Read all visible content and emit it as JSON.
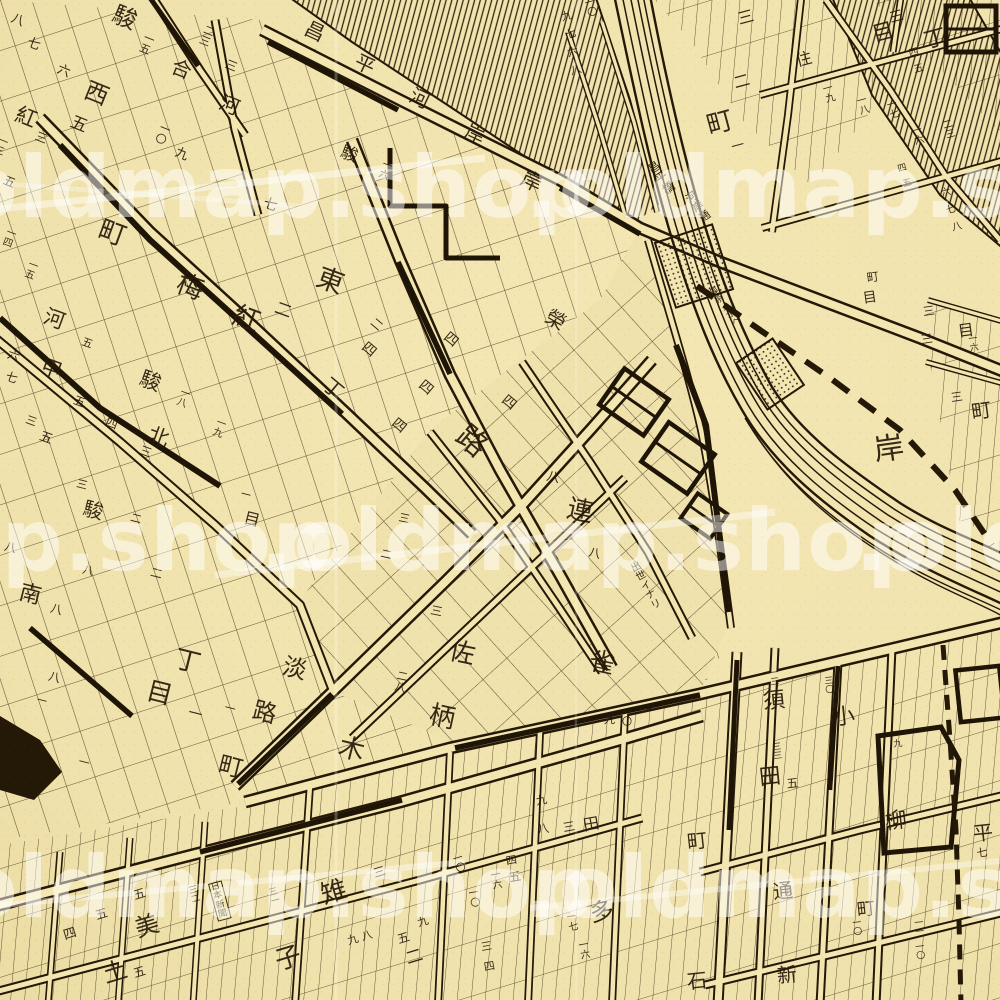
{
  "map": {
    "colors": {
      "paper": "#f0e2ac",
      "ink": "#241807",
      "watermark": "rgba(255,255,255,0.5)"
    },
    "watermark": {
      "text": ".oldmap.shop",
      "rows": [
        {
          "y": 185,
          "xs": [
            -75,
            525
          ]
        },
        {
          "y": 538,
          "xs": [
            -335,
            260,
            855
          ]
        },
        {
          "y": 885,
          "xs": [
            -75,
            525
          ]
        }
      ]
    },
    "labels": [
      {
        "t": "八",
        "x": 14,
        "y": 12,
        "s": 13,
        "r": 22
      },
      {
        "t": "七",
        "x": 30,
        "y": 36,
        "s": 13,
        "r": 22
      },
      {
        "t": "六",
        "x": 60,
        "y": 63,
        "s": 13,
        "r": 22
      },
      {
        "t": "駿",
        "x": 118,
        "y": 2,
        "s": 24,
        "r": 22
      },
      {
        "t": "一五",
        "x": 146,
        "y": 32,
        "s": 11,
        "r": 22,
        "v": 1
      },
      {
        "t": "西",
        "x": 90,
        "y": 78,
        "s": 24,
        "r": 22
      },
      {
        "t": "五",
        "x": 74,
        "y": 114,
        "s": 17,
        "r": 22
      },
      {
        "t": "紅",
        "x": 20,
        "y": 104,
        "s": 21,
        "r": 22
      },
      {
        "t": "三",
        "x": 38,
        "y": 130,
        "s": 12,
        "r": 22
      },
      {
        "t": "二三",
        "x": 206,
        "y": 24,
        "s": 11,
        "r": 22,
        "v": 1
      },
      {
        "t": "三",
        "x": 228,
        "y": 58,
        "s": 12,
        "r": 22
      },
      {
        "t": "合",
        "x": 176,
        "y": 56,
        "s": 20,
        "r": 22
      },
      {
        "t": "河",
        "x": 224,
        "y": 92,
        "s": 20,
        "r": 22
      },
      {
        "t": "一〇",
        "x": 162,
        "y": 122,
        "s": 11,
        "r": 22,
        "v": 1
      },
      {
        "t": "九",
        "x": 178,
        "y": 146,
        "s": 13,
        "r": 22
      },
      {
        "t": "五",
        "x": 6,
        "y": 174,
        "s": 12,
        "r": 22
      },
      {
        "t": "一三",
        "x": 0,
        "y": 136,
        "s": 10,
        "r": 22,
        "v": 1
      },
      {
        "t": "町",
        "x": 104,
        "y": 216,
        "s": 27,
        "r": 20
      },
      {
        "t": "梅",
        "x": 182,
        "y": 270,
        "s": 27,
        "r": 20
      },
      {
        "t": "紅",
        "x": 238,
        "y": 302,
        "s": 27,
        "r": 20
      },
      {
        "t": "東",
        "x": 322,
        "y": 264,
        "s": 27,
        "r": 20
      },
      {
        "t": "二",
        "x": 278,
        "y": 300,
        "s": 17,
        "r": 20
      },
      {
        "t": "七",
        "x": 266,
        "y": 196,
        "s": 14,
        "r": 20
      },
      {
        "t": "駿",
        "x": 344,
        "y": 144,
        "s": 17,
        "r": 20
      },
      {
        "t": "一六",
        "x": 384,
        "y": 160,
        "s": 10,
        "r": 20,
        "v": 1
      },
      {
        "t": "一四",
        "x": 8,
        "y": 228,
        "s": 10,
        "r": 20,
        "v": 1
      },
      {
        "t": "一五",
        "x": 30,
        "y": 260,
        "s": 10,
        "r": 20,
        "v": 1
      },
      {
        "t": "六",
        "x": 10,
        "y": 348,
        "s": 12,
        "r": 20
      },
      {
        "t": "七",
        "x": 8,
        "y": 370,
        "s": 12,
        "r": 20
      },
      {
        "t": "河",
        "x": 48,
        "y": 306,
        "s": 21,
        "r": 20
      },
      {
        "t": "甲",
        "x": 45,
        "y": 356,
        "s": 21,
        "r": 20
      },
      {
        "t": "駿",
        "x": 144,
        "y": 368,
        "s": 21,
        "r": 20
      },
      {
        "t": "北",
        "x": 152,
        "y": 424,
        "s": 21,
        "r": 20
      },
      {
        "t": "五",
        "x": 84,
        "y": 336,
        "s": 11,
        "r": 20
      },
      {
        "t": "五",
        "x": 76,
        "y": 394,
        "s": 12,
        "r": 20
      },
      {
        "t": "四",
        "x": 108,
        "y": 416,
        "s": 12,
        "r": 20
      },
      {
        "t": "三",
        "x": 142,
        "y": 444,
        "s": 12,
        "r": 20
      },
      {
        "t": "一八",
        "x": 182,
        "y": 388,
        "s": 10,
        "r": 20,
        "v": 1
      },
      {
        "t": "一九",
        "x": 218,
        "y": 418,
        "s": 10,
        "r": 20,
        "v": 1
      },
      {
        "t": "五",
        "x": 42,
        "y": 430,
        "s": 13,
        "r": 20
      },
      {
        "t": "三",
        "x": 28,
        "y": 414,
        "s": 11,
        "r": 20
      },
      {
        "t": "二",
        "x": 376,
        "y": 316,
        "s": 12,
        "r": 40
      },
      {
        "t": "四",
        "x": 368,
        "y": 340,
        "s": 14,
        "r": 40
      },
      {
        "t": "四",
        "x": 450,
        "y": 330,
        "s": 14,
        "r": 40
      },
      {
        "t": "四",
        "x": 425,
        "y": 378,
        "s": 14,
        "r": 40
      },
      {
        "t": "四",
        "x": 398,
        "y": 416,
        "s": 14,
        "r": 40
      },
      {
        "t": "四",
        "x": 508,
        "y": 393,
        "s": 14,
        "r": 40
      },
      {
        "t": "丁",
        "x": 332,
        "y": 374,
        "s": 20,
        "r": 40
      },
      {
        "t": "路",
        "x": 470,
        "y": 420,
        "s": 30,
        "r": 40
      },
      {
        "t": "榮",
        "x": 552,
        "y": 306,
        "s": 20,
        "r": 30
      },
      {
        "t": "岸",
        "x": 526,
        "y": 168,
        "s": 21,
        "r": 25
      },
      {
        "t": "昌",
        "x": 310,
        "y": 18,
        "s": 20,
        "r": 25
      },
      {
        "t": "平",
        "x": 360,
        "y": 51,
        "s": 20,
        "r": 25
      },
      {
        "t": "河",
        "x": 415,
        "y": 85,
        "s": 20,
        "r": 25
      },
      {
        "t": "岸",
        "x": 470,
        "y": 121,
        "s": 20,
        "r": 25
      },
      {
        "t": "九",
        "x": 560,
        "y": 12,
        "s": 11,
        "r": -15
      },
      {
        "t": "七",
        "x": 564,
        "y": 30,
        "s": 11,
        "r": -15
      },
      {
        "t": "六",
        "x": 566,
        "y": 48,
        "s": 11,
        "r": -15
      },
      {
        "t": "八",
        "x": 569,
        "y": 66,
        "s": 11,
        "r": -15
      },
      {
        "t": "一〇",
        "x": 584,
        "y": 0,
        "s": 10,
        "r": -15,
        "v": 1
      },
      {
        "t": "昌平橋",
        "x": 646,
        "y": 166,
        "s": 12,
        "r": -35,
        "v": 1
      },
      {
        "t": "河岸通",
        "x": 684,
        "y": 196,
        "s": 11,
        "r": -35,
        "v": 1
      },
      {
        "t": "御茶ノ水ヘ",
        "x": 708,
        "y": 292,
        "s": 9,
        "r": -38,
        "v": 1
      },
      {
        "t": "住",
        "x": 794,
        "y": 54,
        "s": 16,
        "r": -15
      },
      {
        "t": "三",
        "x": 736,
        "y": 12,
        "s": 16,
        "r": -15
      },
      {
        "t": "二",
        "x": 732,
        "y": 76,
        "s": 16,
        "r": -15
      },
      {
        "t": "町",
        "x": 704,
        "y": 114,
        "s": 26,
        "r": -15
      },
      {
        "t": "一",
        "x": 730,
        "y": 142,
        "s": 13,
        "r": -15
      },
      {
        "t": "三",
        "x": 888,
        "y": 12,
        "s": 14,
        "r": -15
      },
      {
        "t": "目",
        "x": 870,
        "y": 26,
        "s": 22,
        "r": -15
      },
      {
        "t": "丁",
        "x": 922,
        "y": 32,
        "s": 22,
        "r": -15
      },
      {
        "t": "四",
        "x": 908,
        "y": 50,
        "s": 10,
        "r": -15
      },
      {
        "t": "五",
        "x": 913,
        "y": 66,
        "s": 10,
        "r": -15
      },
      {
        "t": "一九",
        "x": 822,
        "y": 86,
        "s": 10,
        "r": -15,
        "v": 1
      },
      {
        "t": "一八",
        "x": 856,
        "y": 98,
        "s": 10,
        "r": -15,
        "v": 1
      },
      {
        "t": "一七",
        "x": 886,
        "y": 102,
        "s": 10,
        "r": -15,
        "v": 1
      },
      {
        "t": "一六",
        "x": 911,
        "y": 128,
        "s": 10,
        "r": -15,
        "v": 1
      },
      {
        "t": "二三",
        "x": 942,
        "y": 122,
        "s": 10,
        "r": -15,
        "v": 1
      },
      {
        "t": "六",
        "x": 940,
        "y": 190,
        "s": 10,
        "r": -15
      },
      {
        "t": "七",
        "x": 945,
        "y": 207,
        "s": 10,
        "r": -15
      },
      {
        "t": "八",
        "x": 951,
        "y": 224,
        "s": 10,
        "r": -15
      },
      {
        "t": "四",
        "x": 897,
        "y": 166,
        "s": 9,
        "r": -15
      },
      {
        "t": "五",
        "x": 902,
        "y": 181,
        "s": 9,
        "r": -15
      },
      {
        "t": "町",
        "x": 866,
        "y": 272,
        "s": 12,
        "r": -8
      },
      {
        "t": "目",
        "x": 862,
        "y": 292,
        "s": 14,
        "r": -8
      },
      {
        "t": "三",
        "x": 922,
        "y": 306,
        "s": 12,
        "r": -8
      },
      {
        "t": "三",
        "x": 920,
        "y": 334,
        "s": 12,
        "r": -8
      },
      {
        "t": "目",
        "x": 957,
        "y": 324,
        "s": 16,
        "r": -8
      },
      {
        "t": "一六",
        "x": 968,
        "y": 336,
        "s": 9,
        "r": -8,
        "v": 1
      },
      {
        "t": "岸",
        "x": 872,
        "y": 436,
        "s": 30,
        "r": -8
      },
      {
        "t": "町",
        "x": 970,
        "y": 402,
        "s": 20,
        "r": -8
      },
      {
        "t": "三",
        "x": 950,
        "y": 392,
        "s": 12,
        "r": -8
      },
      {
        "t": "連",
        "x": 570,
        "y": 496,
        "s": 26,
        "r": 12
      },
      {
        "t": "雀",
        "x": 592,
        "y": 648,
        "s": 26,
        "r": 12
      },
      {
        "t": "八",
        "x": 548,
        "y": 470,
        "s": 13,
        "r": 12
      },
      {
        "t": "八",
        "x": 590,
        "y": 546,
        "s": 12,
        "r": 12
      },
      {
        "t": "佐",
        "x": 452,
        "y": 638,
        "s": 26,
        "r": 12
      },
      {
        "t": "柄",
        "x": 432,
        "y": 702,
        "s": 26,
        "r": 12
      },
      {
        "t": "三",
        "x": 432,
        "y": 604,
        "s": 12,
        "r": 12
      },
      {
        "t": "二八",
        "x": 398,
        "y": 670,
        "s": 11,
        "r": 12,
        "v": 1
      },
      {
        "t": "三",
        "x": 400,
        "y": 512,
        "s": 11,
        "r": 12
      },
      {
        "t": "二",
        "x": 382,
        "y": 548,
        "s": 11,
        "r": 12
      },
      {
        "t": "出世イナリ",
        "x": 630,
        "y": 566,
        "s": 10,
        "r": -28,
        "v": 1
      },
      {
        "t": "九",
        "x": 604,
        "y": 714,
        "s": 11,
        "r": 0
      },
      {
        "t": "一〇",
        "x": 622,
        "y": 708,
        "s": 10,
        "r": 0,
        "v": 1
      },
      {
        "t": "一",
        "x": 642,
        "y": 706,
        "s": 10,
        "r": 0
      },
      {
        "t": "淡",
        "x": 286,
        "y": 654,
        "s": 24,
        "r": 14
      },
      {
        "t": "路",
        "x": 256,
        "y": 698,
        "s": 24,
        "r": 14
      },
      {
        "t": "一",
        "x": 226,
        "y": 702,
        "s": 11,
        "r": 14
      },
      {
        "t": "木",
        "x": 342,
        "y": 734,
        "s": 26,
        "r": 14
      },
      {
        "t": "南",
        "x": 22,
        "y": 582,
        "s": 22,
        "r": 14
      },
      {
        "t": "八",
        "x": 6,
        "y": 540,
        "s": 12,
        "r": 14
      },
      {
        "t": "八",
        "x": 52,
        "y": 602,
        "s": 12,
        "r": 14
      },
      {
        "t": "八",
        "x": 50,
        "y": 670,
        "s": 12,
        "r": 14
      },
      {
        "t": "一",
        "x": 38,
        "y": 696,
        "s": 10,
        "r": 14
      },
      {
        "t": "丁",
        "x": 178,
        "y": 646,
        "s": 26,
        "r": 14
      },
      {
        "t": "目",
        "x": 150,
        "y": 678,
        "s": 26,
        "r": 14
      },
      {
        "t": "一",
        "x": 190,
        "y": 706,
        "s": 14,
        "r": 14
      },
      {
        "t": "町",
        "x": 222,
        "y": 752,
        "s": 24,
        "r": 14
      },
      {
        "t": "一",
        "x": 80,
        "y": 756,
        "s": 11,
        "r": 14
      },
      {
        "t": "二",
        "x": 152,
        "y": 566,
        "s": 12,
        "r": 14
      },
      {
        "t": "駿",
        "x": 86,
        "y": 498,
        "s": 20,
        "r": 14
      },
      {
        "t": "三",
        "x": 78,
        "y": 478,
        "s": 11,
        "r": 14
      },
      {
        "t": "八",
        "x": 84,
        "y": 564,
        "s": 11,
        "r": 14
      },
      {
        "t": "一",
        "x": 242,
        "y": 490,
        "s": 10,
        "r": 14
      },
      {
        "t": "目",
        "x": 246,
        "y": 510,
        "s": 16,
        "r": 14
      },
      {
        "t": "二",
        "x": 132,
        "y": 512,
        "s": 11,
        "r": 14
      },
      {
        "t": "須",
        "x": 762,
        "y": 692,
        "s": 22,
        "r": -6
      },
      {
        "t": "田",
        "x": 758,
        "y": 768,
        "s": 22,
        "r": -6
      },
      {
        "t": "五",
        "x": 786,
        "y": 778,
        "s": 12,
        "r": -6
      },
      {
        "t": "三三",
        "x": 772,
        "y": 744,
        "s": 9,
        "r": -6,
        "v": 1
      },
      {
        "t": "一三",
        "x": 769,
        "y": 670,
        "s": 9,
        "r": -6,
        "v": 1
      },
      {
        "t": "小",
        "x": 832,
        "y": 708,
        "s": 22,
        "r": -6
      },
      {
        "t": "三〇",
        "x": 824,
        "y": 678,
        "s": 9,
        "r": -6,
        "v": 1
      },
      {
        "t": "柳",
        "x": 884,
        "y": 812,
        "s": 22,
        "r": -6
      },
      {
        "t": "一九",
        "x": 892,
        "y": 732,
        "s": 9,
        "r": -6,
        "v": 1
      },
      {
        "t": "町",
        "x": 686,
        "y": 832,
        "s": 20,
        "r": -6
      },
      {
        "t": "通",
        "x": 772,
        "y": 882,
        "s": 20,
        "r": -6
      },
      {
        "t": "新",
        "x": 776,
        "y": 966,
        "s": 20,
        "r": -6
      },
      {
        "t": "石",
        "x": 686,
        "y": 972,
        "s": 20,
        "r": -6
      },
      {
        "t": "町",
        "x": 856,
        "y": 902,
        "s": 18,
        "r": -6
      },
      {
        "t": "一〇",
        "x": 852,
        "y": 920,
        "s": 9,
        "r": -6,
        "v": 1
      },
      {
        "t": "一一",
        "x": 914,
        "y": 920,
        "s": 9,
        "r": -6,
        "v": 1
      },
      {
        "t": "一〇",
        "x": 915,
        "y": 944,
        "s": 9,
        "r": -6,
        "v": 1
      },
      {
        "t": "平",
        "x": 972,
        "y": 824,
        "s": 20,
        "r": -6
      },
      {
        "t": "七",
        "x": 976,
        "y": 848,
        "s": 11,
        "r": -6
      },
      {
        "t": "雉",
        "x": 318,
        "y": 884,
        "s": 26,
        "r": -17
      },
      {
        "t": "子",
        "x": 272,
        "y": 950,
        "s": 26,
        "r": -17
      },
      {
        "t": "三",
        "x": 372,
        "y": 868,
        "s": 12,
        "r": -17
      },
      {
        "t": "九",
        "x": 346,
        "y": 936,
        "s": 11,
        "r": -17
      },
      {
        "t": "八",
        "x": 360,
        "y": 932,
        "s": 11,
        "r": -17
      },
      {
        "t": "美",
        "x": 132,
        "y": 918,
        "s": 24,
        "r": -17
      },
      {
        "t": "土",
        "x": 100,
        "y": 964,
        "s": 24,
        "r": -17
      },
      {
        "t": "五",
        "x": 132,
        "y": 890,
        "s": 12,
        "r": -17
      },
      {
        "t": "五",
        "x": 94,
        "y": 910,
        "s": 12,
        "r": -17
      },
      {
        "t": "四",
        "x": 62,
        "y": 930,
        "s": 13,
        "r": -17
      },
      {
        "t": "五",
        "x": 132,
        "y": 968,
        "s": 12,
        "r": -17
      },
      {
        "t": "日本新聞",
        "x": 208,
        "y": 884,
        "s": 9,
        "r": -15,
        "v": 1,
        "b": 1
      },
      {
        "t": "三二",
        "x": 188,
        "y": 888,
        "s": 9,
        "r": -15,
        "v": 1
      },
      {
        "t": "三一",
        "x": 268,
        "y": 890,
        "s": 9,
        "r": -15,
        "v": 1
      },
      {
        "t": "多",
        "x": 588,
        "y": 902,
        "s": 24,
        "r": -10
      },
      {
        "t": "一七",
        "x": 566,
        "y": 914,
        "s": 10,
        "r": -10,
        "v": 1
      },
      {
        "t": "一六",
        "x": 578,
        "y": 942,
        "s": 10,
        "r": -10,
        "v": 1
      },
      {
        "t": "田",
        "x": 582,
        "y": 818,
        "s": 16,
        "r": -10
      },
      {
        "t": "三",
        "x": 562,
        "y": 822,
        "s": 12,
        "r": -10
      },
      {
        "t": "八",
        "x": 536,
        "y": 824,
        "s": 12,
        "r": -10
      },
      {
        "t": "九",
        "x": 535,
        "y": 796,
        "s": 11,
        "r": -10
      },
      {
        "t": "五",
        "x": 508,
        "y": 872,
        "s": 12,
        "r": -10
      },
      {
        "t": "四",
        "x": 505,
        "y": 856,
        "s": 11,
        "r": -10
      },
      {
        "t": "一〇",
        "x": 468,
        "y": 890,
        "s": 10,
        "r": -10,
        "v": 1
      },
      {
        "t": "一六",
        "x": 490,
        "y": 872,
        "s": 10,
        "r": -10,
        "v": 1
      },
      {
        "t": "三",
        "x": 480,
        "y": 942,
        "s": 11,
        "r": -10
      },
      {
        "t": "四",
        "x": 483,
        "y": 962,
        "s": 11,
        "r": -10
      },
      {
        "t": "二",
        "x": 404,
        "y": 952,
        "s": 17,
        "r": -17
      },
      {
        "t": "一〇",
        "x": 452,
        "y": 856,
        "s": 10,
        "r": -17,
        "v": 1
      },
      {
        "t": "九",
        "x": 416,
        "y": 918,
        "s": 11,
        "r": -17
      },
      {
        "t": "五",
        "x": 396,
        "y": 934,
        "s": 12,
        "r": -17
      }
    ]
  }
}
